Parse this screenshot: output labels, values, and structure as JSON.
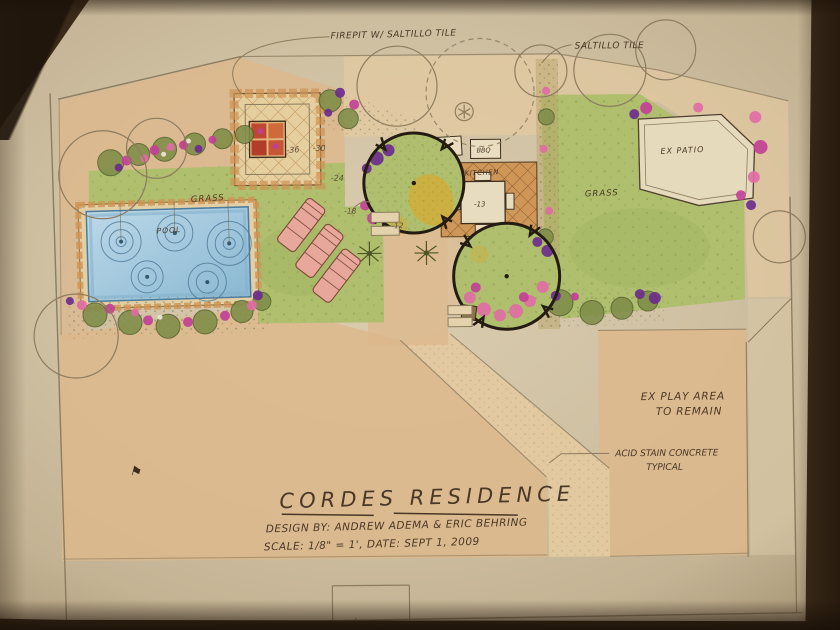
{
  "drawing": {
    "callouts": {
      "firepit": "FIREPIT W/ SALTILLO TILE",
      "saltillo": "SALTILLO TILE",
      "acid_stain_line1": "ACID STAIN CONCRETE",
      "acid_stain_line2": "TYPICAL",
      "ex_play_line1": "EX PLAY AREA",
      "ex_play_line2": "TO REMAIN"
    },
    "area_labels": {
      "grass_left": "GRASS",
      "grass_right": "GRASS",
      "pool": "POOL",
      "kitchen": "KITCHEN",
      "bbq": "BBQ",
      "counter": "BB",
      "ex_patio": "EX PATIO"
    },
    "dimensions": {
      "firepit_width": "-36",
      "patio_30": "-30",
      "patio_24": "-24",
      "walk_18": "-18",
      "walk_12": "-12",
      "table_13": "-13"
    },
    "title_block": {
      "title": "CORDES RESIDENCE",
      "byline": "DESIGN BY: ANDREW ADEMA & ERIC BEHRING",
      "scale_date": "SCALE: 1/8\" = 1', DATE: SEPT 1, 2009"
    },
    "marks": {
      "flag": "⚑"
    },
    "palette": {
      "paper": "#cfc0a2",
      "paper_edge": "#a6936f",
      "ink": "#4a3827",
      "pencil": "#8d7c5f",
      "grass": "#afbf6e",
      "grass_dark": "#87974d",
      "pool_water": "#a6c9dd",
      "pool_deep": "#6f9fbe",
      "concrete": "#ddb88c",
      "concrete_light": "#e3c9a0",
      "tile_orange": "#cf9352",
      "firepit_red": "#bf4730",
      "flower_magenta": "#c23e97",
      "flower_pink": "#e06ba4",
      "flower_purple": "#6d2d8c",
      "shrub_olive": "#7f8d48",
      "accent_yellow": "#d8a92f"
    }
  }
}
